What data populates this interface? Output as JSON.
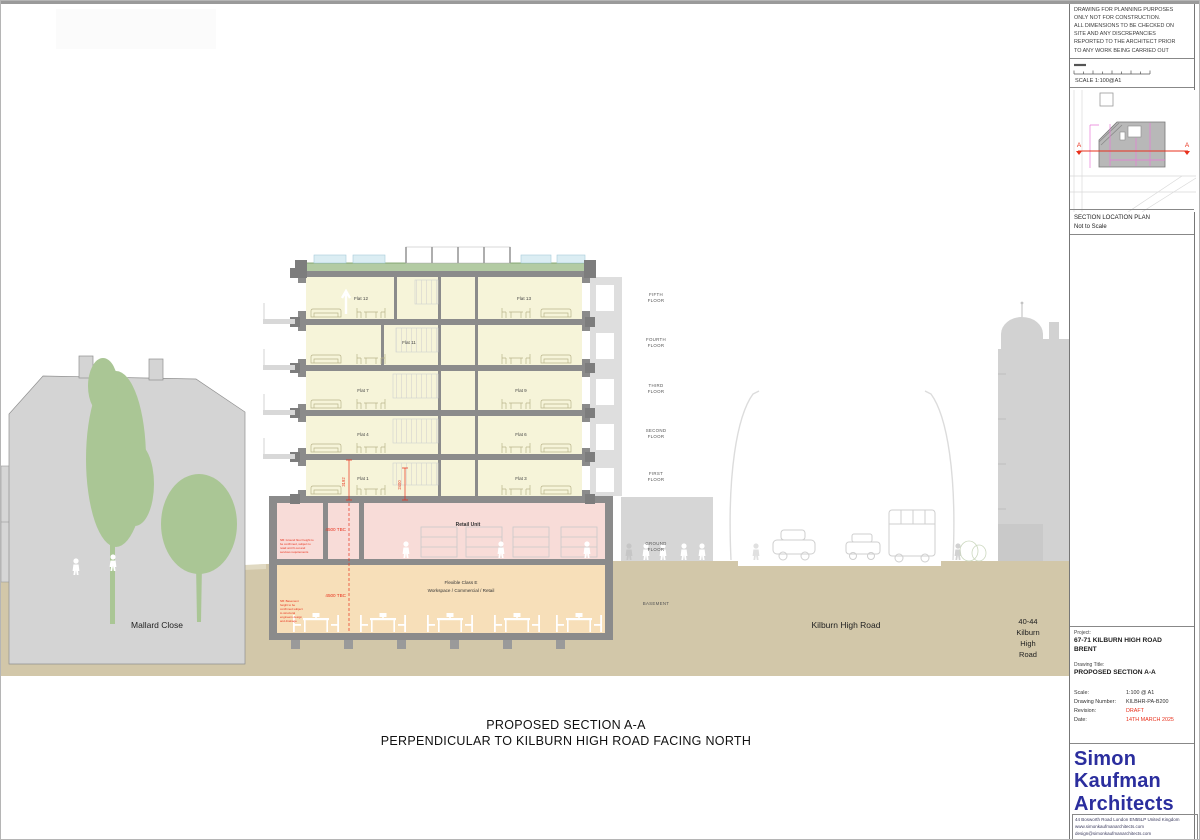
{
  "panel": {
    "notes": [
      "DRAWING FOR PLANNING PURPOSES",
      "ONLY NOT FOR CONSTRUCTION.",
      "ALL DIMENSIONS TO BE CHECKED ON",
      "SITE AND ANY DISCREPANCIES",
      "REPORTED TO THE ARCHITECT PRIOR",
      "TO ANY WORK BEING CARRIED OUT"
    ],
    "scale_label": "SCALE 1:100@A1",
    "location_plan_title": "SECTION LOCATION PLAN",
    "location_plan_subtitle": "Not to Scale",
    "section_marker": "A",
    "title_block": {
      "project_label": "Project:",
      "project_line1": "67-71 KILBURN HIGH ROAD",
      "project_line2": "BRENT",
      "drawing_title_label": "Drawing Title:",
      "drawing_title": "PROPOSED SECTION A-A",
      "scale_label": "Scale:",
      "scale_value": "1:100 @ A1",
      "number_label": "Drawing Number:",
      "number_value": "KILBHR-PA-B200",
      "revision_label": "Revision:",
      "revision_value": "DRAFT",
      "date_label": "Date:",
      "date_value": "14TH MARCH 2025"
    },
    "logo": {
      "line1": "Simon",
      "line2": "Kaufman",
      "line3": "Architects"
    },
    "footer": [
      "44 Bosworth Road London EN55LP United Kingdom",
      "www.simonkaufmanarchitects.com",
      "design@simonkaufmanarchitects.com"
    ]
  },
  "drawing": {
    "main_title_line1": "PROPOSED SECTION A-A",
    "main_title_line2": "PERPENDICULAR TO KILBURN HIGH ROAD FACING NORTH",
    "street_left": "Mallard Close",
    "street_right": "Kilburn High Road",
    "neighbour_address": [
      "40-44",
      "Kilburn",
      "High",
      "Road"
    ],
    "floor_labels": [
      {
        "l1": "FIFTH",
        "l2": "FLOOR"
      },
      {
        "l1": "FOURTH",
        "l2": "FLOOR"
      },
      {
        "l1": "THIRD",
        "l2": "FLOOR"
      },
      {
        "l1": "SECOND",
        "l2": "FLOOR"
      },
      {
        "l1": "FIRST",
        "l2": "FLOOR"
      },
      {
        "l1": "GROUND",
        "l2": "FLOOR"
      },
      {
        "l1": "BASEMENT",
        "l2": ""
      }
    ],
    "flats": {
      "fifth_left": "Flat 12",
      "fifth_right": "Flat 13",
      "fourth": "Flat 11",
      "third_left": "Flat 7",
      "third_right": "Flat 9",
      "second_left": "Flat 4",
      "second_right": "Flat 6",
      "first_left": "Flat 1",
      "first_right": "Flat 3"
    },
    "ground_unit": "Retail Unit",
    "basement_unit_line1": "Flexible Class E",
    "basement_unit_line2": "Workspace / Commercial / Retail",
    "dimensions": {
      "first_floor_a": "3192",
      "first_floor_b": "2400",
      "ground": "4500 TBC",
      "basement": "4500 TBC"
    },
    "ground_note": [
      "NB: Ground floor height to",
      "be confirmed, subject to",
      "retail unit fit out and",
      "services requirements"
    ],
    "basement_note": [
      "NB: Basement",
      "height to be",
      "confirmed subject",
      "to structural",
      "engineers design",
      "and drainage"
    ]
  },
  "colors": {
    "accent_red": "#e8311c",
    "logo_navy": "#2b2e9e",
    "flat_yellow": "#f6f4d9",
    "retail_pink": "#f8dcd8",
    "basement_tan": "#f7dfb9",
    "earth": "#d2c7a9",
    "context_gray": "#d4d4d4",
    "tree_green": "#aac695",
    "roof_green": "#b3cba3",
    "skylight_blue": "#dbedf3"
  }
}
